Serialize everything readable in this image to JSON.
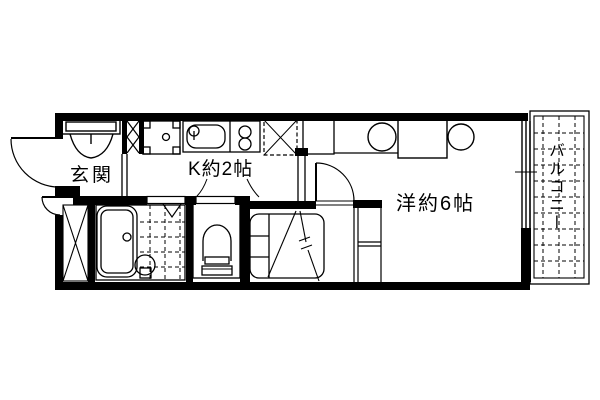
{
  "page": {
    "background_color": "#ffffff",
    "line_color": "#000000",
    "type": "apartment-floorplan"
  },
  "floorplan": {
    "rooms": {
      "entrance": {
        "label": "玄関"
      },
      "kitchen": {
        "label": "K約2帖"
      },
      "main_room": {
        "label": "洋約6帖"
      },
      "balcony": {
        "label": "バルコニー"
      }
    },
    "fixtures": [
      "entrance-closet",
      "pipe-space",
      "washing-machine-pan",
      "kitchen-sink",
      "gas-stove-2-burner",
      "refrigerator-space",
      "storage-x-space",
      "bathtub",
      "shower-area",
      "shower-fixture",
      "toilet",
      "bed-with-loft-above",
      "loft-ladder-shelf",
      "dining-table",
      "chairs",
      "entrance-door",
      "storage-door",
      "room-door",
      "bathroom-door",
      "toilet-door",
      "sliding-window",
      "balcony-deck-grid"
    ]
  }
}
